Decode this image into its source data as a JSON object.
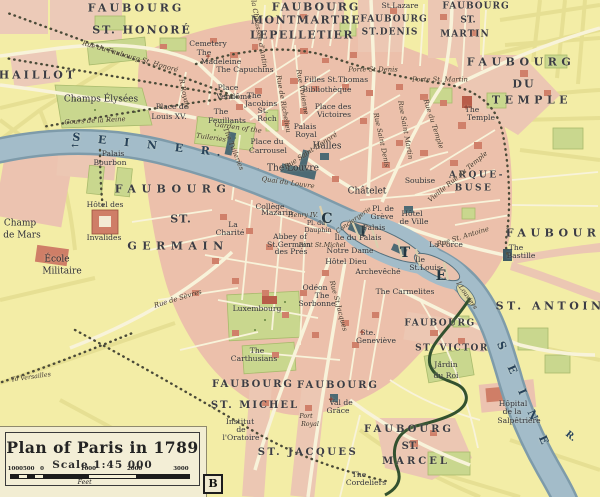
{
  "map": {
    "type": "historical-city-map",
    "legend": {
      "title": "Plan of Paris in 1789",
      "scale_text": "Scale 1:45 000",
      "scale_bar": {
        "labels": [
          "1000",
          "500",
          "0",
          "1000",
          "2000",
          "3000"
        ],
        "positions_pct": [
          3,
          10.5,
          18,
          44,
          70,
          96
        ],
        "unit": "Feet"
      },
      "plate_letter": "B"
    },
    "colors": {
      "background": "#f3eda6",
      "city_block": "#ecc0ab",
      "building_red": "#d0806a",
      "building_dark": "#4d6a74",
      "park": "#c9d78e",
      "river": "#a3bcc9",
      "road": "#f8f3da",
      "text": "#33333b",
      "river_text": "#27425a"
    },
    "labels": [
      {
        "t": "FAUBOURG",
        "x": 136,
        "y": 8,
        "c": "big",
        "ls": 3
      },
      {
        "t": "ST. HONORÉ",
        "x": 142,
        "y": 30,
        "c": "big",
        "ls": 2
      },
      {
        "t": "FAUBOURG",
        "x": 316,
        "y": 7,
        "c": "big",
        "ls": 2
      },
      {
        "t": "MONTMARTRE",
        "x": 306,
        "y": 20,
        "c": "big",
        "ls": 1.5
      },
      {
        "t": "LEPELLETIER",
        "x": 302,
        "y": 35,
        "c": "big",
        "ls": 1.5
      },
      {
        "t": "St.Lazare",
        "x": 400,
        "y": 6,
        "c": "small"
      },
      {
        "t": "FAUBOURG",
        "x": 394,
        "y": 20,
        "c": "med",
        "ls": 1
      },
      {
        "t": "ST.DENIS",
        "x": 390,
        "y": 33,
        "c": "med",
        "ls": 1
      },
      {
        "t": "FAUBOURG",
        "x": 476,
        "y": 7,
        "c": "med",
        "ls": 1
      },
      {
        "t": "ST.",
        "x": 468,
        "y": 21,
        "c": "med"
      },
      {
        "t": "MARTIN",
        "x": 465,
        "y": 35,
        "c": "med",
        "ls": 1
      },
      {
        "t": "FAUBOURG",
        "x": 521,
        "y": 62,
        "c": "big",
        "ls": 4.5
      },
      {
        "t": "DU",
        "x": 524,
        "y": 84,
        "c": "big",
        "ls": 2
      },
      {
        "t": "TEMPLE",
        "x": 532,
        "y": 100,
        "c": "big",
        "ls": 4.5
      },
      {
        "t": "CHAILLOT",
        "x": 32,
        "y": 75,
        "c": "big",
        "ls": 3
      },
      {
        "t": "FAUBOURG",
        "x": 173,
        "y": 189,
        "c": "big",
        "ls": 5.5
      },
      {
        "t": "ST.",
        "x": 181,
        "y": 219,
        "c": "big",
        "ls": 1
      },
      {
        "t": "GERMAIN",
        "x": 178,
        "y": 246,
        "c": "big",
        "ls": 5.5
      },
      {
        "t": "FAUBOURG",
        "x": 560,
        "y": 233,
        "c": "big",
        "ls": 4.5
      },
      {
        "t": "ST. ANTOINE",
        "x": 556,
        "y": 306,
        "c": "big",
        "ls": 3.5
      },
      {
        "t": "ARQUE-",
        "x": 477,
        "y": 176,
        "c": "med2",
        "ls": 2.5
      },
      {
        "t": "BUSE",
        "x": 474,
        "y": 189,
        "c": "med2",
        "ls": 2.5
      },
      {
        "t": "FAUBOURG",
        "x": 253,
        "y": 385,
        "c": "big2",
        "ls": 2
      },
      {
        "t": "ST. MICHEL",
        "x": 255,
        "y": 406,
        "c": "big2",
        "ls": 2
      },
      {
        "t": "FAUBOURG",
        "x": 338,
        "y": 386,
        "c": "big2",
        "ls": 2
      },
      {
        "t": "ST. JACQUES",
        "x": 308,
        "y": 453,
        "c": "big2",
        "ls": 2.5
      },
      {
        "t": "FAUBOURG",
        "x": 409,
        "y": 430,
        "c": "big2",
        "ls": 3
      },
      {
        "t": "ST.",
        "x": 410,
        "y": 447,
        "c": "big2"
      },
      {
        "t": "MARCEL",
        "x": 416,
        "y": 462,
        "c": "big2",
        "ls": 3
      },
      {
        "t": "FAUBOURG",
        "x": 440,
        "y": 324,
        "c": "med2",
        "ls": 1.5
      },
      {
        "t": "ST. VICTOR",
        "x": 452,
        "y": 349,
        "c": "med2",
        "ls": 1.5
      },
      {
        "t": "C",
        "x": 327,
        "y": 219,
        "c": "cite"
      },
      {
        "t": "I",
        "x": 363,
        "y": 232,
        "c": "cite"
      },
      {
        "t": "T",
        "x": 405,
        "y": 253,
        "c": "cite"
      },
      {
        "t": "É",
        "x": 441,
        "y": 276,
        "c": "cite"
      },
      {
        "t": "Cemetery",
        "x": 208,
        "y": 44,
        "c": "small"
      },
      {
        "t": "The",
        "x": 204,
        "y": 53,
        "c": "small"
      },
      {
        "t": "Madeleine",
        "x": 221,
        "y": 62,
        "c": "small"
      },
      {
        "t": "The Capuchins",
        "x": 245,
        "y": 70,
        "c": "small"
      },
      {
        "t": "Place de",
        "x": 172,
        "y": 107,
        "c": "small"
      },
      {
        "t": "Louis XV.",
        "x": 169,
        "y": 117,
        "c": "small"
      },
      {
        "t": "Place",
        "x": 228,
        "y": 88,
        "c": "small"
      },
      {
        "t": "Vendôme",
        "x": 234,
        "y": 97,
        "c": "small"
      },
      {
        "t": "The",
        "x": 221,
        "y": 112,
        "c": "small"
      },
      {
        "t": "Feuillants",
        "x": 227,
        "y": 121,
        "c": "small"
      },
      {
        "t": "The",
        "x": 254,
        "y": 96,
        "c": "small"
      },
      {
        "t": "Jacobins",
        "x": 261,
        "y": 104,
        "c": "small"
      },
      {
        "t": "St.",
        "x": 263,
        "y": 111,
        "c": "small"
      },
      {
        "t": "Roch",
        "x": 267,
        "y": 119,
        "c": "small"
      },
      {
        "t": "Filles St.Thomas",
        "x": 336,
        "y": 80,
        "c": "small"
      },
      {
        "t": "Bibliothèque",
        "x": 327,
        "y": 90,
        "c": "small"
      },
      {
        "t": "Place des",
        "x": 333,
        "y": 107,
        "c": "small"
      },
      {
        "t": "Victoires",
        "x": 334,
        "y": 115,
        "c": "small"
      },
      {
        "t": "Palais",
        "x": 305,
        "y": 127,
        "c": "small"
      },
      {
        "t": "Royal",
        "x": 306,
        "y": 135,
        "c": "small"
      },
      {
        "t": "Place du",
        "x": 267,
        "y": 142,
        "c": "small"
      },
      {
        "t": "Carrousel",
        "x": 268,
        "y": 151,
        "c": "small"
      },
      {
        "t": "Halles",
        "x": 327,
        "y": 147,
        "c": "place"
      },
      {
        "t": "The Louvre",
        "x": 293,
        "y": 169,
        "c": "place"
      },
      {
        "t": "Châtelet",
        "x": 367,
        "y": 192,
        "c": "place"
      },
      {
        "t": "Pl. de",
        "x": 383,
        "y": 209,
        "c": "small"
      },
      {
        "t": "Grève",
        "x": 382,
        "y": 217,
        "c": "small"
      },
      {
        "t": "Hôtel",
        "x": 412,
        "y": 214,
        "c": "small"
      },
      {
        "t": "de Ville",
        "x": 414,
        "y": 222,
        "c": "small"
      },
      {
        "t": "Soubise",
        "x": 420,
        "y": 181,
        "c": "small"
      },
      {
        "t": "La Force",
        "x": 446,
        "y": 245,
        "c": "small"
      },
      {
        "t": "The",
        "x": 516,
        "y": 248,
        "c": "small"
      },
      {
        "t": "Bastille",
        "x": 521,
        "y": 256,
        "c": "small"
      },
      {
        "t": "The",
        "x": 472,
        "y": 110,
        "c": "small"
      },
      {
        "t": "Temple",
        "x": 481,
        "y": 118,
        "c": "small"
      },
      {
        "t": "Conciergerie",
        "x": 354,
        "y": 221,
        "c": "tiny-i",
        "r": -35
      },
      {
        "t": "Palais",
        "x": 374,
        "y": 228,
        "c": "small"
      },
      {
        "t": "Île du Palais",
        "x": 358,
        "y": 238,
        "c": "small"
      },
      {
        "t": "Notre Dame",
        "x": 350,
        "y": 251,
        "c": "small"
      },
      {
        "t": "Hôtel Dieu",
        "x": 346,
        "y": 262,
        "c": "small"
      },
      {
        "t": "Archevêché",
        "x": 378,
        "y": 272,
        "c": "small"
      },
      {
        "t": "Île",
        "x": 420,
        "y": 260,
        "c": "small"
      },
      {
        "t": "St.Louis",
        "x": 425,
        "y": 268,
        "c": "small"
      },
      {
        "t": "Î.Louviers",
        "x": 466,
        "y": 296,
        "c": "tiny-i",
        "r": 55
      },
      {
        "t": "Henry IV.",
        "x": 303,
        "y": 216,
        "c": "tiny-i"
      },
      {
        "t": "Pl. du",
        "x": 316,
        "y": 224,
        "c": "tiny"
      },
      {
        "t": "Dauphin",
        "x": 318,
        "y": 231,
        "c": "tiny"
      },
      {
        "t": "Pont St.Michel",
        "x": 322,
        "y": 246,
        "c": "tiny-i"
      },
      {
        "t": "Collège",
        "x": 270,
        "y": 207,
        "c": "small"
      },
      {
        "t": "Mazarin",
        "x": 277,
        "y": 213,
        "c": "small"
      },
      {
        "t": "La",
        "x": 233,
        "y": 225,
        "c": "small"
      },
      {
        "t": "Charité",
        "x": 230,
        "y": 233,
        "c": "small"
      },
      {
        "t": "Abbey of",
        "x": 290,
        "y": 237,
        "c": "small"
      },
      {
        "t": "St.Germain",
        "x": 289,
        "y": 245,
        "c": "small"
      },
      {
        "t": "des Prés",
        "x": 291,
        "y": 252,
        "c": "small"
      },
      {
        "t": "Palais",
        "x": 113,
        "y": 154,
        "c": "small"
      },
      {
        "t": "Bourbon",
        "x": 110,
        "y": 163,
        "c": "small"
      },
      {
        "t": "Hôtel des",
        "x": 105,
        "y": 205,
        "c": "small"
      },
      {
        "t": "Invalides",
        "x": 104,
        "y": 238,
        "c": "small"
      },
      {
        "t": "Champ",
        "x": 20,
        "y": 224,
        "c": "place"
      },
      {
        "t": "de Mars",
        "x": 22,
        "y": 236,
        "c": "place"
      },
      {
        "t": "École",
        "x": 57,
        "y": 260,
        "c": "place"
      },
      {
        "t": "Militaire",
        "x": 62,
        "y": 272,
        "c": "place"
      },
      {
        "t": "Luxembourg",
        "x": 257,
        "y": 309,
        "c": "small"
      },
      {
        "t": "The",
        "x": 257,
        "y": 351,
        "c": "small"
      },
      {
        "t": "Carthusians",
        "x": 254,
        "y": 359,
        "c": "small"
      },
      {
        "t": "Odéon",
        "x": 315,
        "y": 288,
        "c": "small"
      },
      {
        "t": "The",
        "x": 322,
        "y": 296,
        "c": "small"
      },
      {
        "t": "Sorbonne",
        "x": 317,
        "y": 304,
        "c": "small"
      },
      {
        "t": "Ste.",
        "x": 368,
        "y": 333,
        "c": "small"
      },
      {
        "t": "Geneviève",
        "x": 376,
        "y": 341,
        "c": "small"
      },
      {
        "t": "The Carmelites",
        "x": 405,
        "y": 292,
        "c": "small"
      },
      {
        "t": "Val de",
        "x": 341,
        "y": 403,
        "c": "small"
      },
      {
        "t": "Grâce",
        "x": 338,
        "y": 411,
        "c": "small"
      },
      {
        "t": "Port",
        "x": 306,
        "y": 417,
        "c": "tiny-i"
      },
      {
        "t": "Royal",
        "x": 310,
        "y": 425,
        "c": "tiny-i"
      },
      {
        "t": "Institut",
        "x": 240,
        "y": 422,
        "c": "small"
      },
      {
        "t": "de",
        "x": 241,
        "y": 430,
        "c": "small"
      },
      {
        "t": "l'Oratoire",
        "x": 241,
        "y": 438,
        "c": "small"
      },
      {
        "t": "The",
        "x": 359,
        "y": 475,
        "c": "small"
      },
      {
        "t": "Cordeliers",
        "x": 366,
        "y": 483,
        "c": "small"
      },
      {
        "t": "Jardin",
        "x": 446,
        "y": 365,
        "c": "small"
      },
      {
        "t": "du Roi",
        "x": 446,
        "y": 376,
        "c": "small"
      },
      {
        "t": "Hôpital",
        "x": 513,
        "y": 404,
        "c": "small"
      },
      {
        "t": "de la",
        "x": 512,
        "y": 412,
        "c": "small"
      },
      {
        "t": "Salpêtrière",
        "x": 519,
        "y": 421,
        "c": "small"
      },
      {
        "t": "Rue du Faubourg St. Honoré",
        "x": 130,
        "y": 57,
        "c": "street",
        "r": 16
      },
      {
        "t": "Champs Élysées",
        "x": 101,
        "y": 100,
        "c": "place"
      },
      {
        "t": "Cours de la Reine",
        "x": 95,
        "y": 121,
        "c": "street",
        "r": -3
      },
      {
        "t": "R.Royale",
        "x": 184,
        "y": 94,
        "c": "street",
        "r": 78
      },
      {
        "t": "Garden of the",
        "x": 238,
        "y": 128,
        "c": "street",
        "r": 8
      },
      {
        "t": "Tuileries",
        "x": 211,
        "y": 138,
        "c": "street",
        "r": 8
      },
      {
        "t": "The Tuileries",
        "x": 233,
        "y": 149,
        "c": "street",
        "r": 68
      },
      {
        "t": "R. de la Chaussée d'Antin",
        "x": 257,
        "y": 24,
        "c": "street",
        "r": 80
      },
      {
        "t": "Rue de Richelieu",
        "x": 283,
        "y": 104,
        "c": "street",
        "r": 80
      },
      {
        "t": "Rue Vivienne",
        "x": 302,
        "y": 92,
        "c": "street",
        "r": 80
      },
      {
        "t": "Porte St.Denis",
        "x": 373,
        "y": 70,
        "c": "street"
      },
      {
        "t": "Porte St. Martin",
        "x": 440,
        "y": 80,
        "c": "street"
      },
      {
        "t": "Rue Saint Denis",
        "x": 381,
        "y": 140,
        "c": "street",
        "r": 78
      },
      {
        "t": "Rue Saint Martin",
        "x": 405,
        "y": 130,
        "c": "street",
        "r": 80
      },
      {
        "t": "Rue du Temple",
        "x": 433,
        "y": 124,
        "c": "street",
        "r": 72
      },
      {
        "t": "Vieille Rue du Temple",
        "x": 458,
        "y": 177,
        "c": "street",
        "r": -40
      },
      {
        "t": "Rue St. Antoine",
        "x": 463,
        "y": 237,
        "c": "street",
        "r": -17
      },
      {
        "t": "Rue Saint Honoré",
        "x": 311,
        "y": 151,
        "c": "street",
        "r": -33
      },
      {
        "t": "Quai du Louvre",
        "x": 288,
        "y": 183,
        "c": "street",
        "r": 8
      },
      {
        "t": "Rue St.Jacques",
        "x": 338,
        "y": 306,
        "c": "street",
        "r": 75
      },
      {
        "t": "Rue de Sèvres",
        "x": 178,
        "y": 299,
        "c": "street",
        "r": -17
      },
      {
        "t": "To Versailles",
        "x": 31,
        "y": 378,
        "c": "tiny-i",
        "r": -8
      },
      {
        "t": "S E I N E   R.",
        "x": 150,
        "y": 145,
        "c": "river",
        "r": 6
      },
      {
        "t": "S E I N E",
        "x": 524,
        "y": 396,
        "c": "river",
        "r": 66
      },
      {
        "t": "R.",
        "x": 570,
        "y": 437,
        "c": "river-sm",
        "r": 40
      },
      {
        "t": "←",
        "x": 75,
        "y": 147,
        "c": "river-sm"
      },
      {
        "t": "+",
        "x": 208,
        "y": 56,
        "c": "cross"
      },
      {
        "t": "+",
        "x": 466,
        "y": 107,
        "c": "cross"
      },
      {
        "t": "+",
        "x": 331,
        "y": 399,
        "c": "cross"
      },
      {
        "t": "+",
        "x": 362,
        "y": 332,
        "c": "cross"
      }
    ]
  }
}
